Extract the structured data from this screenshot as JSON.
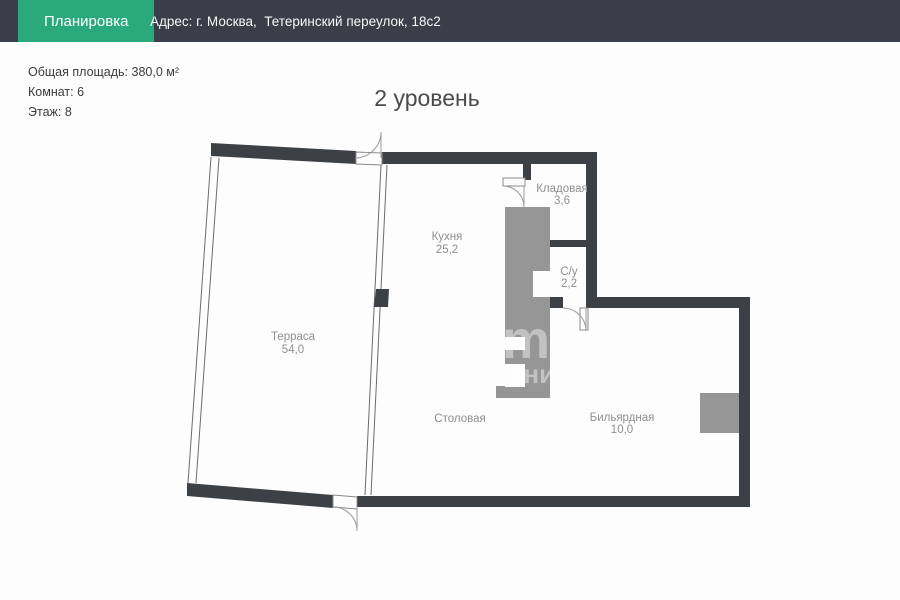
{
  "header": {
    "badge": "Планировка",
    "address": "Адрес: г. Москва,  Тетеринский переулок, 18с2"
  },
  "info": {
    "total_area": "Общая площадь: 380,0 м²",
    "rooms_count": "Комнат: 6",
    "floor": "Этаж: 8"
  },
  "plan": {
    "level_title": "2 уровень",
    "rooms": [
      {
        "name": "Терраса",
        "area": "54,0"
      },
      {
        "name": "Кухня",
        "area": "25,2"
      },
      {
        "name": "Кладовая",
        "area": "3,6"
      },
      {
        "name": "С/у",
        "area": "2,2"
      },
      {
        "name": "Столовая",
        "area": ""
      },
      {
        "name": "Бильярдная",
        "area": "10,0"
      }
    ],
    "watermark": {
      "line1": "m",
      "line2": "ени"
    }
  },
  "colors": {
    "header_bg": "#3a3e49",
    "accent_green": "#2aa97c",
    "wall": "#3d4145",
    "shaft_gray": "#969696",
    "label_gray": "#8f8f8f"
  }
}
